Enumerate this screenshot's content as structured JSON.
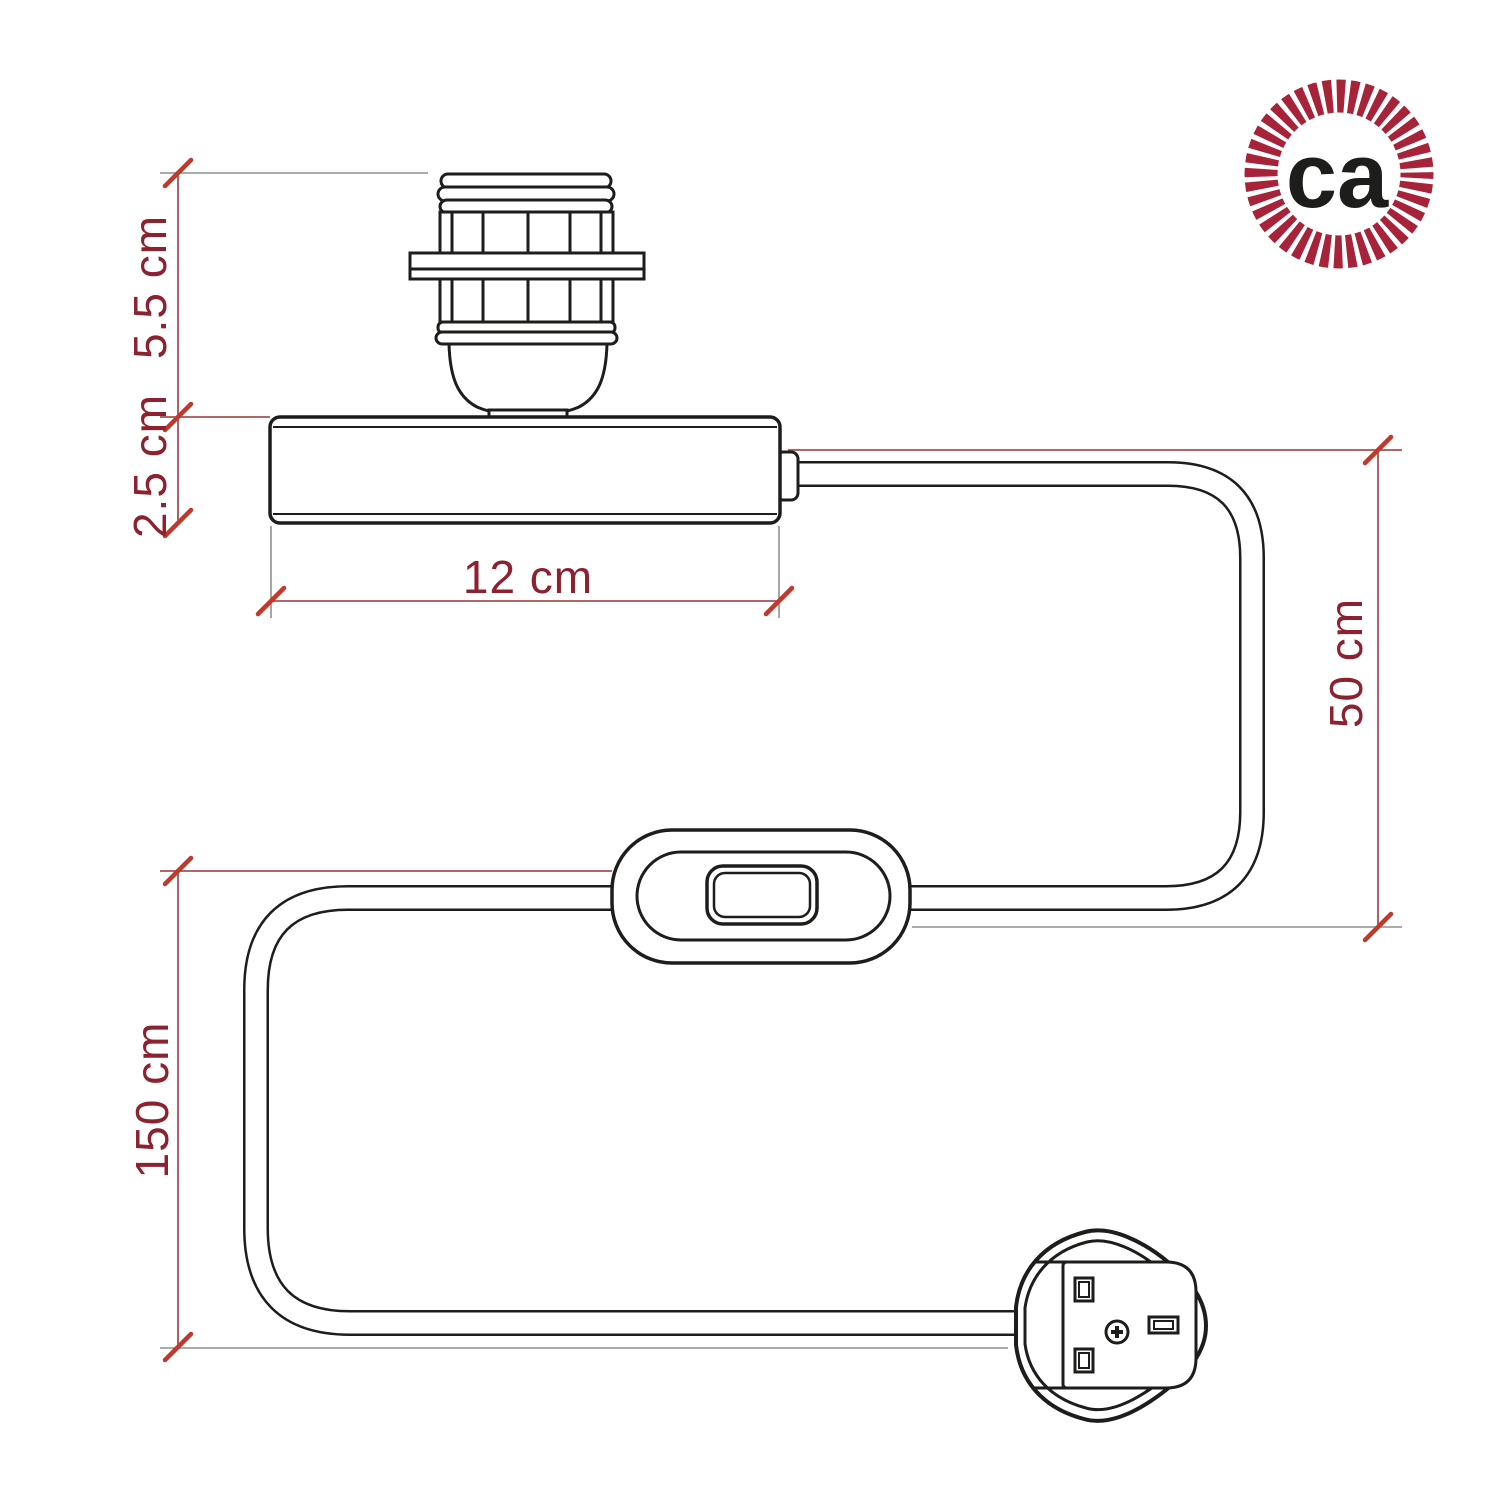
{
  "background_color": "#ffffff",
  "logo": {
    "text": "ca",
    "ring_color": "#a62339",
    "text_color": "#1d1d1b"
  },
  "drawing": {
    "ink_color": "#1d1d1b"
  },
  "dimension_style": {
    "text_color": "#8c2130",
    "line_color": "#a85050",
    "tick_color": "#c0392b",
    "extension_color": "#8f8f8f"
  },
  "dimensions": {
    "lamp_holder_height": "5.5 cm",
    "base_height": "2.5 cm",
    "base_width": "12 cm",
    "cable_base_to_switch": "50 cm",
    "cable_switch_to_plug": "150 cm"
  }
}
